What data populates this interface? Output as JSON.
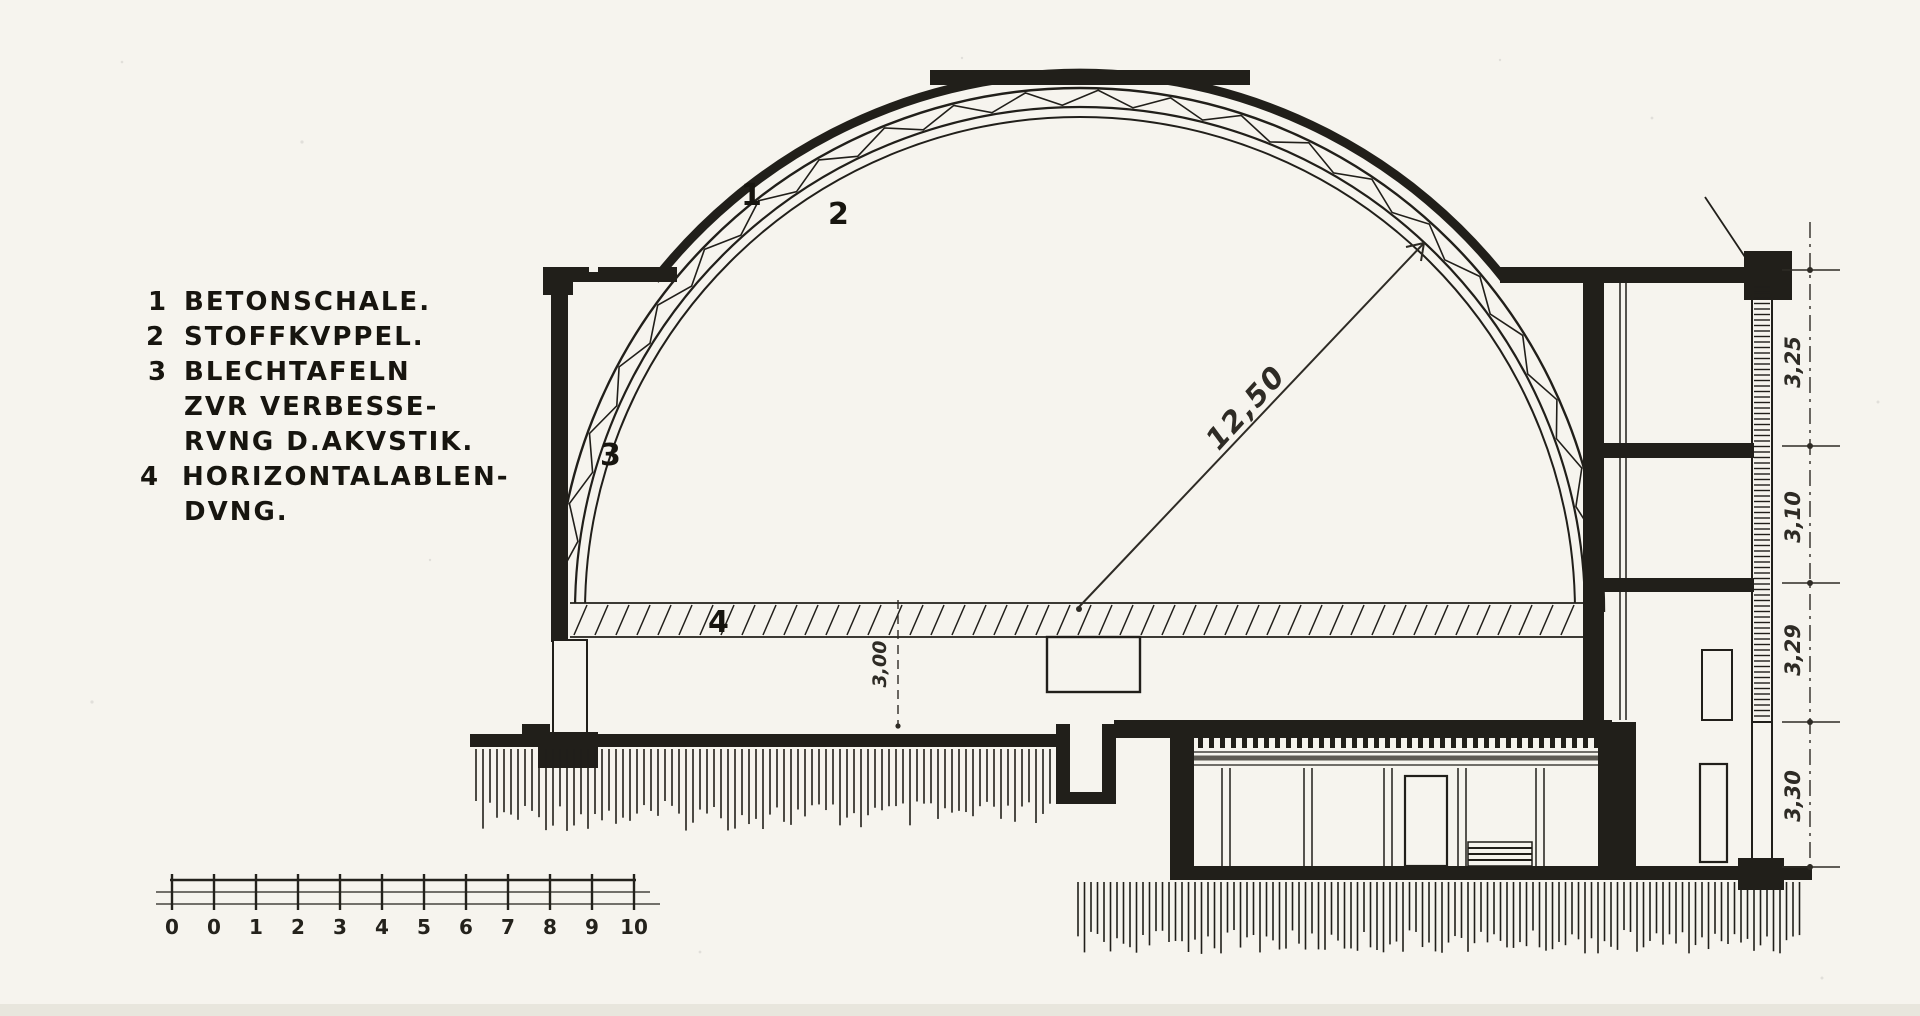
{
  "drawing_title": "Dome building cross-section (Kuppel Schnitt)",
  "colors": {
    "paper": "#f6f4ee",
    "ink": "#211f1a"
  },
  "legend": {
    "items": [
      {
        "num": "1",
        "lines": [
          "BETONSCHALE."
        ]
      },
      {
        "num": "2",
        "lines": [
          "STOFFKVPPEL."
        ]
      },
      {
        "num": "3",
        "lines": [
          "BLECHTAFELN",
          "ZVR VERBESSE-",
          "RVNG D.AKVSTIK."
        ]
      },
      {
        "num": "4",
        "lines": [
          "HORIZONTALABLEN-",
          "DVNG."
        ]
      }
    ]
  },
  "callouts": {
    "c1": "1",
    "c2": "2",
    "c3": "3",
    "c4": "4"
  },
  "dimensions": {
    "radius": "12,50",
    "center_height": "3,00",
    "right_floor_heights": [
      "3,25",
      "3,10",
      "3,29",
      "3,30"
    ]
  },
  "scale_bar": {
    "labels": [
      "0",
      "0",
      "1",
      "2",
      "3",
      "4",
      "5",
      "6",
      "7",
      "8",
      "9",
      "10"
    ]
  }
}
